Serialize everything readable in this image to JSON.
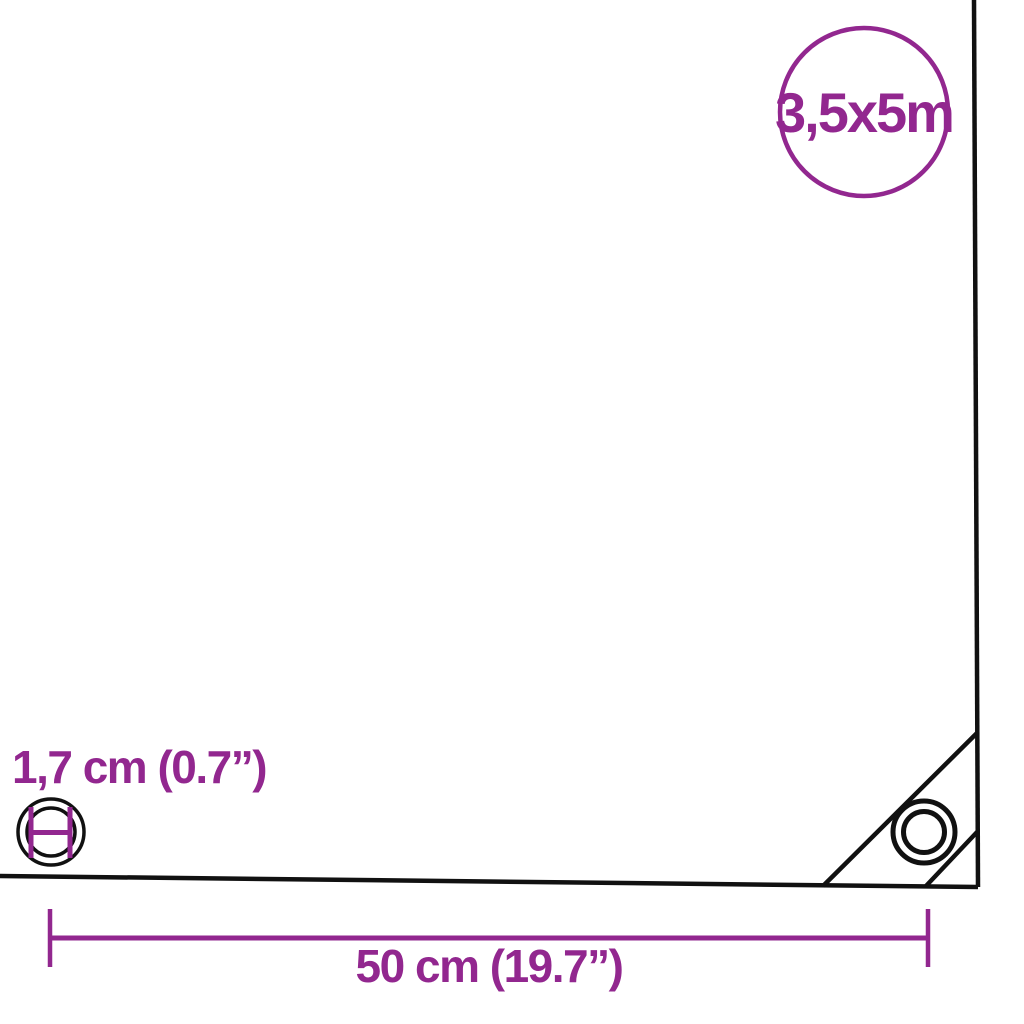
{
  "colors": {
    "accent": "#92278F",
    "line": "#111111",
    "background": "#ffffff"
  },
  "size_badge": {
    "label": "3,5x5m",
    "shape": "circle-outline"
  },
  "eyelet": {
    "diameter_label": "1,7 cm (0.7”)",
    "icon": "concentric-rings-with-diameter-marker"
  },
  "grommet_spacing": {
    "label": "50 cm (19.7”)",
    "style": "dimension-line-with-end-ticks"
  },
  "corner_detail": {
    "icon": "reinforced-corner-with-grommet"
  }
}
